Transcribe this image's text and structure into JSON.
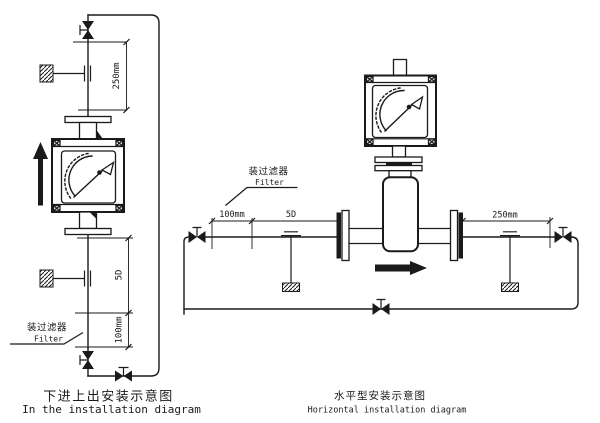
{
  "colors": {
    "ink": "#1a1a1a",
    "paper": "#ffffff"
  },
  "diagrams": {
    "left": {
      "dims": {
        "d250": "250mm",
        "d5d": "5D",
        "d100": "100mm"
      },
      "filter": {
        "cn": "装过滤器",
        "en": "Filter"
      },
      "caption": {
        "cn": "下进上出安装示意图",
        "en": "In the installation diagram"
      }
    },
    "right": {
      "dims": {
        "d100": "100mm",
        "d5d": "5D",
        "d250": "250mm"
      },
      "filter": {
        "cn": "装过滤器",
        "en": "Filter"
      },
      "caption": {
        "cn": "水平型安装示意图",
        "en": "Horizontal installation diagram"
      }
    }
  }
}
